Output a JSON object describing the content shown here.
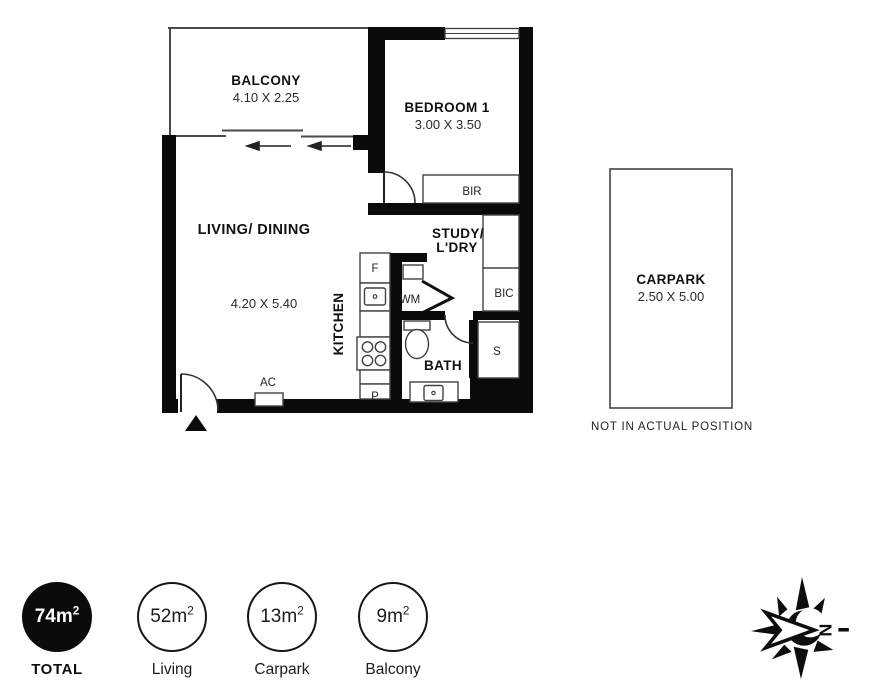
{
  "plan": {
    "balcony": {
      "name": "BALCONY",
      "dim": "4.10 X 2.25"
    },
    "bedroom": {
      "name": "BEDROOM 1",
      "dim": "3.00 X 3.50"
    },
    "living": {
      "name": "LIVING/ DINING",
      "dim": "4.20 X 5.40"
    },
    "kitchen": {
      "name": "KITCHEN"
    },
    "study": {
      "line1": "STUDY/",
      "line2": "L'DRY"
    },
    "bath": {
      "name": "BATH"
    },
    "carpark": {
      "name": "CARPARK",
      "dim": "2.50 X 5.00",
      "note": "NOT IN ACTUAL POSITION"
    },
    "fixtures": {
      "fridge": "F",
      "pantry": "P",
      "washing_machine": "WM",
      "robe": "BIR",
      "cupboard": "BIC",
      "shower": "S",
      "aircon": "AC"
    }
  },
  "legend": {
    "items": [
      {
        "value": "74m",
        "sup": "2",
        "label": "TOTAL"
      },
      {
        "value": "52m",
        "sup": "2",
        "label": "Living"
      },
      {
        "value": "13m",
        "sup": "2",
        "label": "Carpark"
      },
      {
        "value": "9m",
        "sup": "2",
        "label": "Balcony"
      }
    ]
  },
  "compass": {
    "north": "N"
  },
  "colors": {
    "wall": "#0a0a0a",
    "line": "#4a4a4a",
    "text": "#111111"
  }
}
